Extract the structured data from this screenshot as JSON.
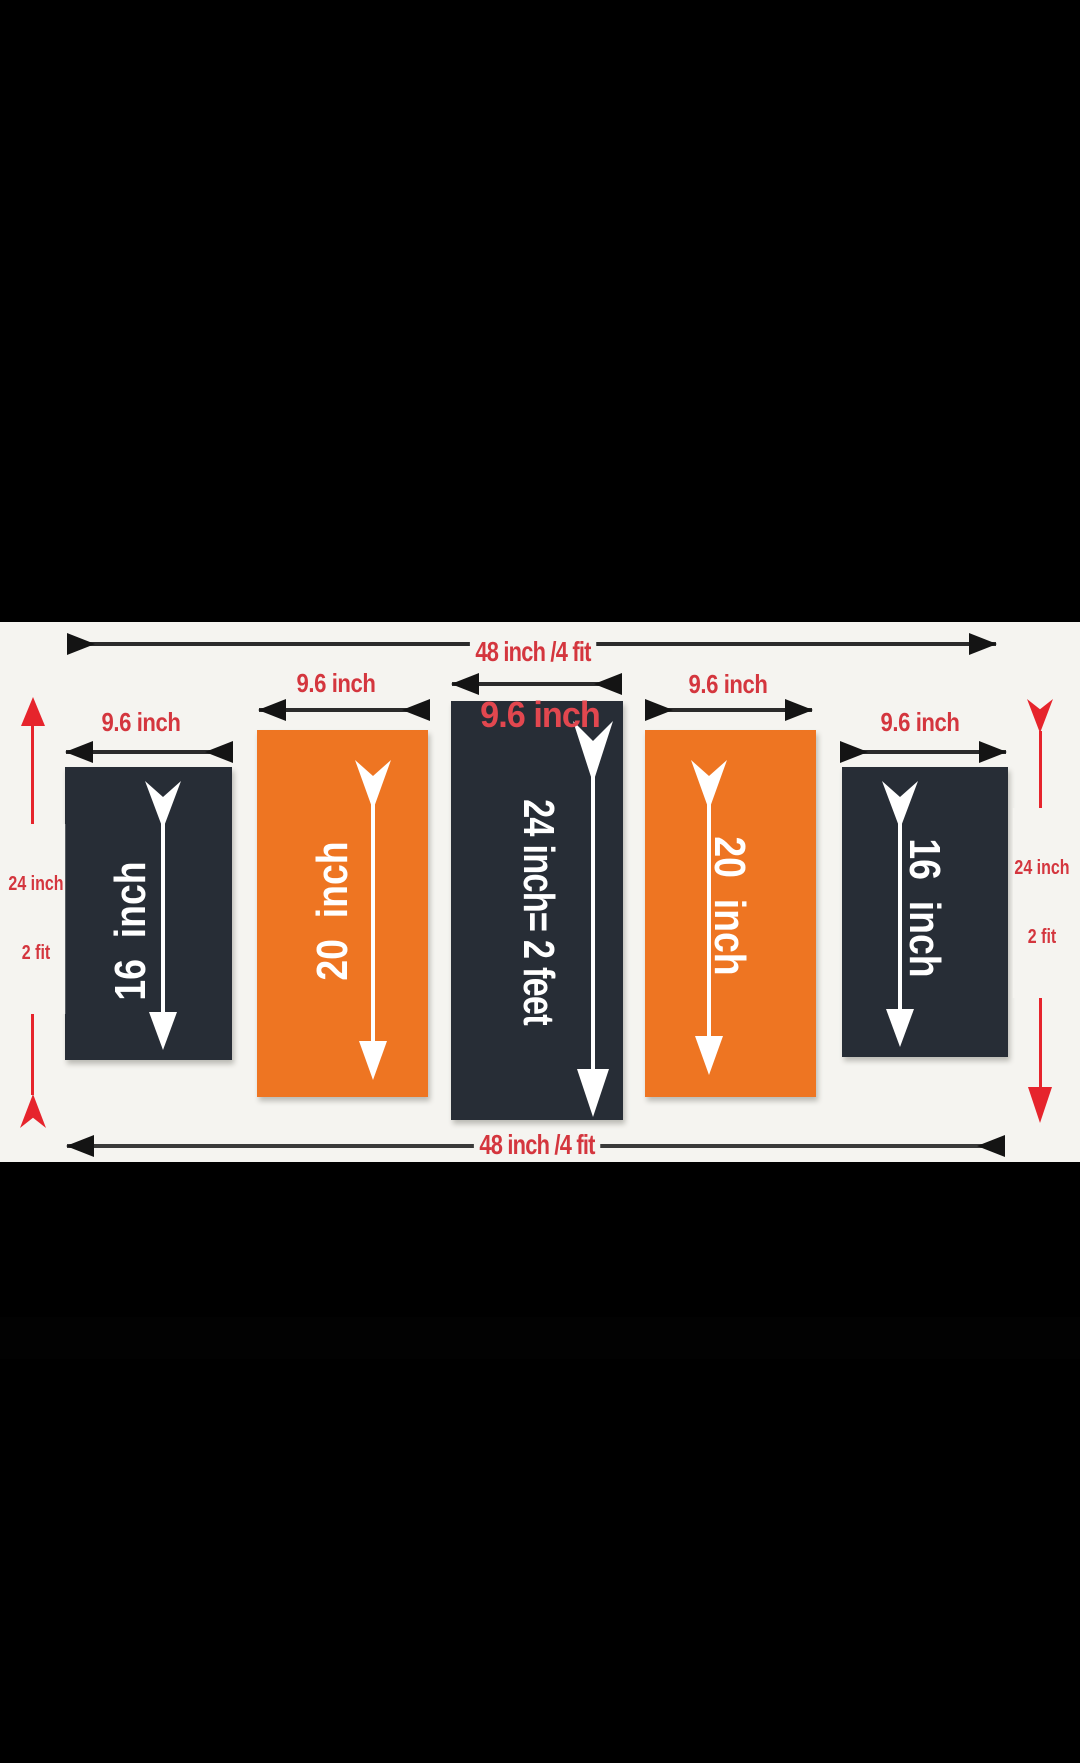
{
  "colors": {
    "letterbox": "#000000",
    "canvas_bg": "#f5f4f0",
    "panel_dark": "#272d36",
    "panel_orange": "#ee7522",
    "dimension_text_red": "#d4363e",
    "dimension_line_red": "#e6242c",
    "arrow_black": "#141414",
    "arrow_white": "#ffffff"
  },
  "top_width": {
    "label": "48 inch /4 fit"
  },
  "bottom_width": {
    "label": "48 inch /4 fit"
  },
  "left_height": {
    "line1": "24 inch",
    "line2": "2 fit"
  },
  "right_height": {
    "line1": "24 inch",
    "line2": "2 fit"
  },
  "center_overlay": {
    "label": "9.6 inch"
  },
  "panels": [
    {
      "name": "panel-1",
      "color": "dark",
      "width_label": "9.6 inch",
      "height_label": "16  inch"
    },
    {
      "name": "panel-2",
      "color": "orange",
      "width_label": "9.6 inch",
      "height_label": "20  inch"
    },
    {
      "name": "panel-3",
      "color": "dark",
      "width_label": "9.6 inch",
      "height_label": "24 inch= 2 feet"
    },
    {
      "name": "panel-4",
      "color": "orange",
      "width_label": "9.6 inch",
      "height_label": "20  inch"
    },
    {
      "name": "panel-5",
      "color": "dark",
      "width_label": "9.6 inch",
      "height_label": "16  inch"
    }
  ]
}
